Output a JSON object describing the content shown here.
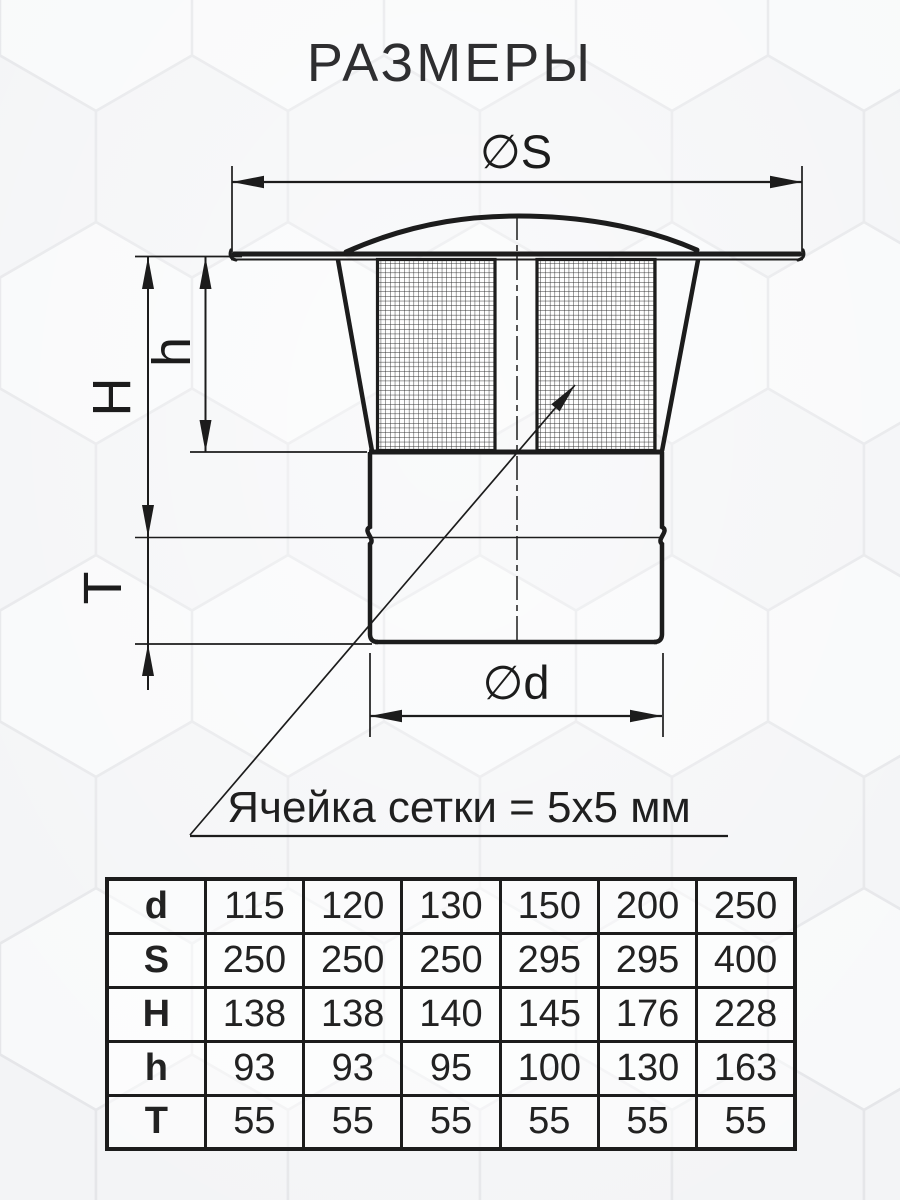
{
  "title": "РАЗМЕРЫ",
  "drawing": {
    "dim_s": "∅S",
    "dim_d": "∅d",
    "dim_H": "H",
    "dim_h": "h",
    "dim_T": "T",
    "note": "Ячейка сетки = 5х5 мм"
  },
  "table": {
    "rows": [
      {
        "label": "d",
        "values": [
          "115",
          "120",
          "130",
          "150",
          "200",
          "250"
        ]
      },
      {
        "label": "S",
        "values": [
          "250",
          "250",
          "250",
          "295",
          "295",
          "400"
        ]
      },
      {
        "label": "H",
        "values": [
          "138",
          "138",
          "140",
          "145",
          "176",
          "228"
        ]
      },
      {
        "label": "h",
        "values": [
          "93",
          "93",
          "95",
          "100",
          "130",
          "163"
        ]
      },
      {
        "label": "T",
        "values": [
          "55",
          "55",
          "55",
          "55",
          "55",
          "55"
        ]
      }
    ]
  },
  "colors": {
    "line": "#1c1c1c",
    "background": "#eff0f2"
  }
}
